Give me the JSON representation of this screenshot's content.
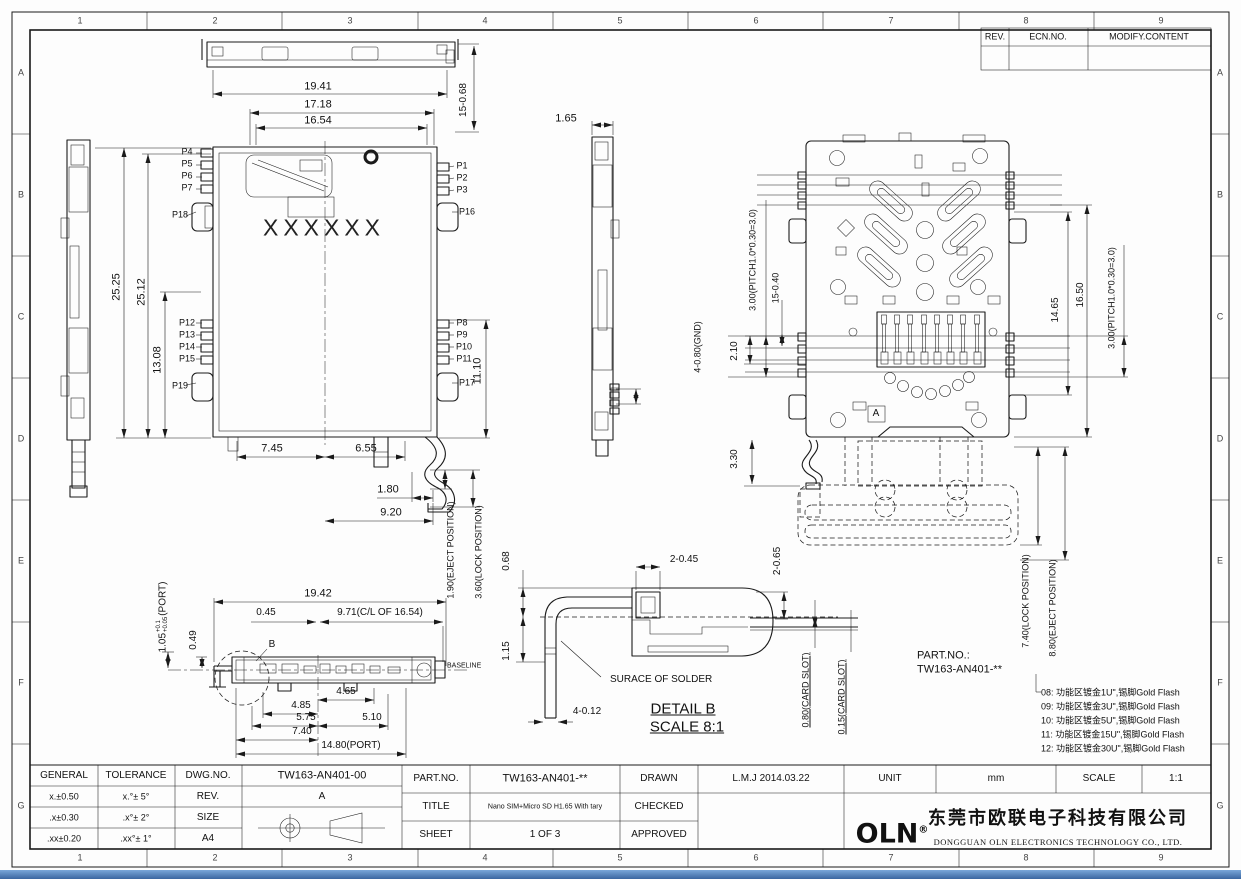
{
  "frame": {
    "columns": [
      "1",
      "2",
      "3",
      "4",
      "5",
      "6",
      "7",
      "8",
      "9"
    ],
    "rows": [
      "A",
      "B",
      "C",
      "D",
      "E",
      "F",
      "G"
    ]
  },
  "rev_table": {
    "rev": "REV.",
    "ecn": "ECN.NO.",
    "modify": "MODIFY.CONTENT"
  },
  "views": {
    "top": {
      "d1941": "19.41",
      "d1718": "17.18",
      "d1654": "16.54",
      "d15_068": "15-0.68",
      "marking": "XXXXXX",
      "pins": {
        "p1": "P1",
        "p2": "P2",
        "p3": "P3",
        "p4": "P4",
        "p5": "P5",
        "p6": "P6",
        "p7": "P7",
        "p8": "P8",
        "p9": "P9",
        "p10": "P10",
        "p11": "P11",
        "p12": "P12",
        "p13": "P13",
        "p14": "P14",
        "p15": "P15",
        "p16": "P16",
        "p17": "P17",
        "p18": "P18",
        "p19": "P19"
      },
      "d2525": "25.25",
      "d2512": "25.12",
      "d1308": "13.08",
      "d1110": "11.10",
      "d745": "7.45",
      "d655": "6.55",
      "d180": "1.80",
      "d920": "9.20",
      "d190": "1.90(EJECT POSITION)",
      "d360": "3.60(LOCK POSITION)"
    },
    "side": {
      "d165": "1.65",
      "dgnd": "4-0.80(GND)"
    },
    "bottom": {
      "dpitch_left": "3.00(PITCH1.0*0.30=3.0)",
      "d15_040": "15-0.40",
      "d210": "2.10",
      "d330": "3.30",
      "d1465": "14.65",
      "d1650": "16.50",
      "dpitch_right": "3.00(PITCH1.0*0.30=3.0)",
      "datum": "A",
      "d740": "7.40(LOCK POSITION)",
      "d880": "8.80(EJECT POSITION)"
    },
    "front": {
      "d1942": "19.42",
      "d045": "0.45",
      "d971": "9.71(C/L OF 16.54)",
      "dport_val": "1.05",
      "dport_tol_up": "+0.1",
      "dport_tol_dn": "+0.05",
      "dport_suffix": "(PORT)",
      "d049": "0.49",
      "detail_ref": "B",
      "baseline": "BASELINE",
      "d465": "4.65",
      "d485": "4.85",
      "d575": "5.75",
      "d510": "5.10",
      "d740": "7.40",
      "d1480": "14.80(PORT)"
    },
    "detail_b": {
      "d068": "0.68",
      "d115": "1.15",
      "d2_045": "2-0.45",
      "d2_065": "2-0.65",
      "surface": "SURACE OF SOLDER",
      "d4_012": "4-0.12",
      "title": "DETAIL B",
      "scale": "SCALE 8:1",
      "d080": "0.80(CARD SLOT)",
      "d015": "0.15(CARD SLOT)"
    }
  },
  "part_note": {
    "label": "PART.NO.:",
    "number": "TW163-AN401-**",
    "options": [
      "08: 功能区镀金1U\",锡脚Gold Flash",
      "09: 功能区镀金3U\",锡脚Gold Flash",
      "10: 功能区镀金5U\",锡脚Gold Flash",
      "11: 功能区镀金15U\",锡脚Gold Flash",
      "12: 功能区镀金30U\",锡脚Gold Flash"
    ]
  },
  "title_block": {
    "general": "GENERAL",
    "tolerance": "TOLERANCE",
    "dwg_no_label": "DWG.NO.",
    "dwg_no": "TW163-AN401-00",
    "tol_rows": [
      [
        "x.±0.50",
        "x.°± 5°"
      ],
      [
        ".x±0.30",
        ".x°± 2°"
      ],
      [
        ".xx±0.20",
        ".xx°± 1°"
      ]
    ],
    "rev_label": "REV.",
    "rev": "A",
    "size_label": "SIZE",
    "size": "A4",
    "part_no_label": "PART.NO.",
    "part_no": "TW163-AN401-**",
    "title_label": "TITLE",
    "title": "Nano SIM+Micro SD H1.65 With tary",
    "sheet_label": "SHEET",
    "sheet": "1 OF 3",
    "drawn_label": "DRAWN",
    "drawn": "L.M.J 2014.03.22",
    "checked_label": "CHECKED",
    "approved_label": "APPROVED",
    "unit_label": "UNIT",
    "unit": "mm",
    "scale_label": "SCALE",
    "scale": "1:1",
    "logo": "OLN",
    "logo_reg": "®",
    "company_cn": "东莞市欧联电子科技有限公司",
    "company_en": "DONGGUAN OLN ELECTRONICS TECHNOLOGY CO., LTD."
  }
}
